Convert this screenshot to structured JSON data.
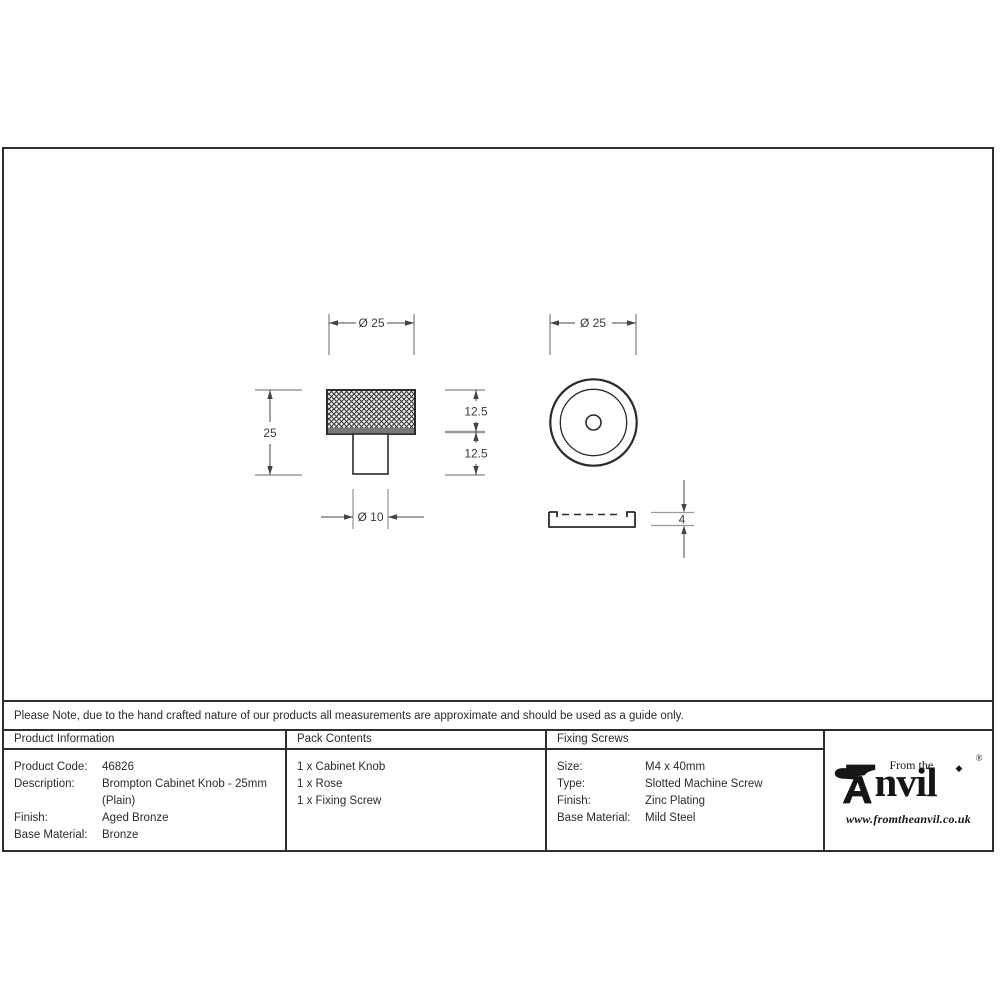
{
  "drawing": {
    "front_view": {
      "dim_head_diameter": "Ø 25",
      "dim_total_height": "25",
      "dim_upper_height": "12.5",
      "dim_lower_height": "12.5",
      "dim_stem_diameter": "Ø 10"
    },
    "top_view": {
      "dim_diameter": "Ø 25"
    },
    "rose_profile": {
      "dim_thickness": "4"
    }
  },
  "note": {
    "text": "Please Note, due to the hand crafted nature of our products all measurements are approximate and should be used as a guide only."
  },
  "table": {
    "product_information": {
      "header": "Product Information",
      "rows": [
        {
          "label": "Product Code:",
          "value": "46826"
        },
        {
          "label": "Description:",
          "value": "Brompton Cabinet Knob - 25mm (Plain)"
        },
        {
          "label": "Finish:",
          "value": "Aged Bronze"
        },
        {
          "label": "Base Material:",
          "value": "Bronze"
        }
      ]
    },
    "pack_contents": {
      "header": "Pack Contents",
      "items": [
        "1 x Cabinet Knob",
        "1 x Rose",
        "1 x Fixing Screw"
      ]
    },
    "fixing_screws": {
      "header": "Fixing Screws",
      "rows": [
        {
          "label": "Size:",
          "value": "M4 x 40mm"
        },
        {
          "label": "Type:",
          "value": "Slotted Machine Screw"
        },
        {
          "label": "Finish:",
          "value": "Zinc Plating"
        },
        {
          "label": "Base Material:",
          "value": "Mild Steel"
        }
      ]
    }
  },
  "logo": {
    "prefix": "From the",
    "brand_rest": "nvil",
    "registered_mark": "®",
    "diamond": "◆",
    "website": "www.fromtheanvil.co.uk"
  },
  "colors": {
    "outline": "#2b2b2b",
    "dimension_line": "#444444",
    "light_extension": "#9a9a9a"
  }
}
